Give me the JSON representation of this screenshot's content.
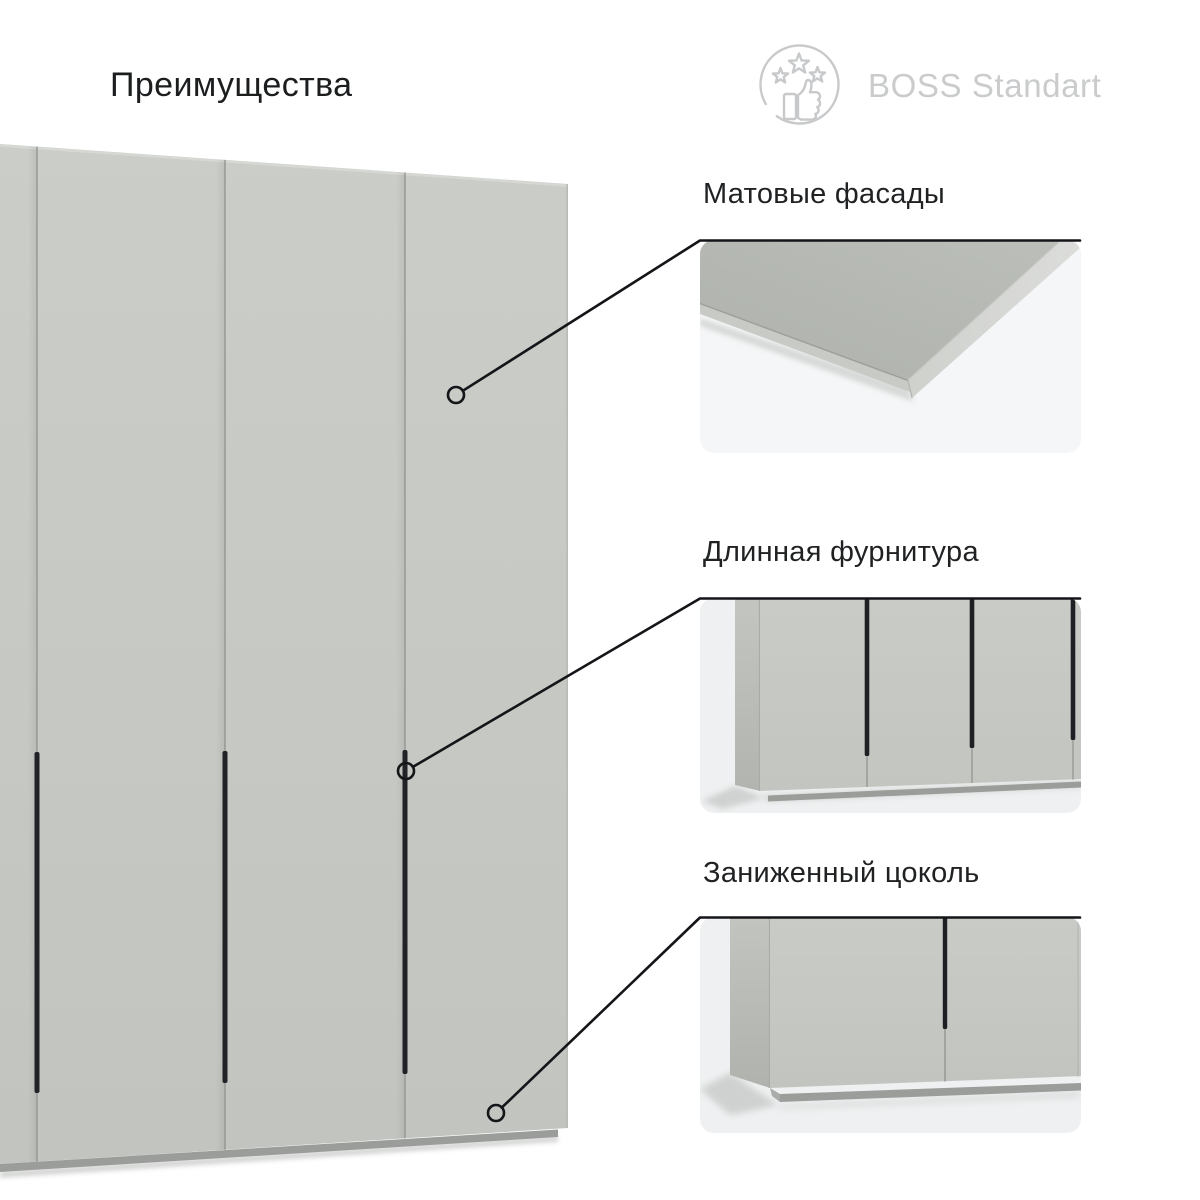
{
  "page": {
    "title": "Преимущества",
    "background": "#ffffff"
  },
  "brand": {
    "name": "BOSS Standart",
    "icon": "thumbs-up-with-stars",
    "text_color": "#c9cbcc",
    "icon_color": "#c7c9cb"
  },
  "wardrobe": {
    "description": "four-door matte gray wardrobe with long black vertical handles",
    "door_color": "#c7c9c5",
    "gap_color": "#90938f",
    "handle_color": "#212225",
    "plinth_color": "#9a9d99"
  },
  "callouts": {
    "line_color": "#141518"
  },
  "features": [
    {
      "label": "Матовые фасады",
      "image": "matte-facade-corner-closeup"
    },
    {
      "label": "Длинная фурнитура",
      "image": "wardrobe-long-handles-closeup"
    },
    {
      "label": "Заниженный цоколь",
      "image": "wardrobe-low-plinth-closeup"
    }
  ]
}
